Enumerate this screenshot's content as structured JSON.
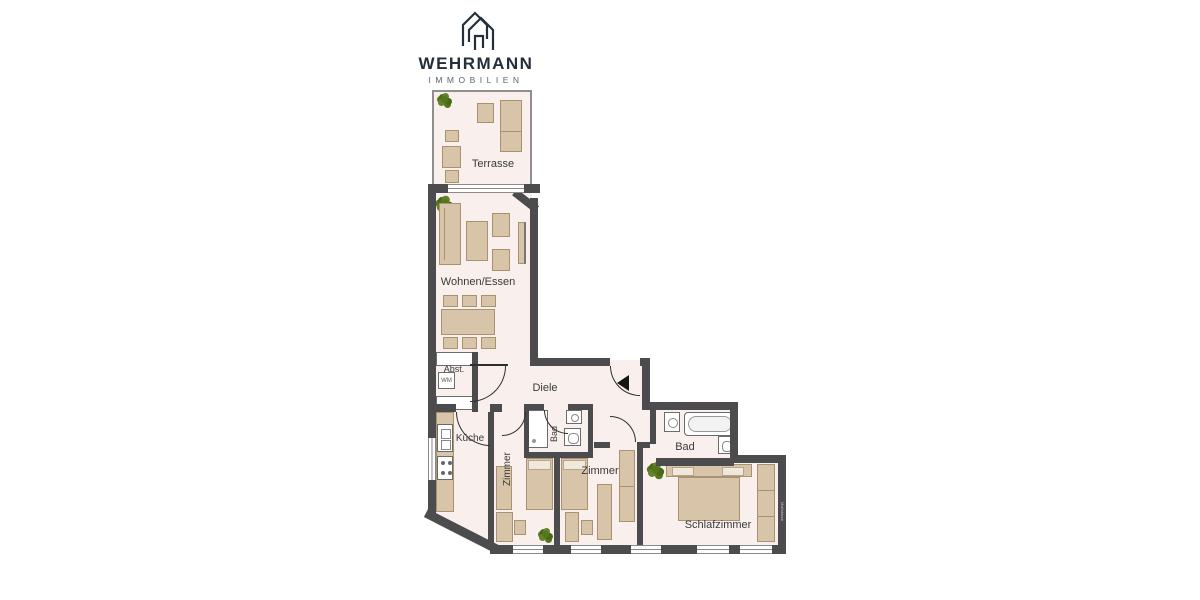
{
  "brand": {
    "name": "WEHRMANN",
    "subtitle": "IMMOBILIEN"
  },
  "floorplan": {
    "labels": {
      "terrasse": "Terrasse",
      "wohnen_essen": "Wohnen/Essen",
      "abstellraum": "Abst.",
      "washing_machine": "WM",
      "diele": "Diele",
      "kueche": "Küche",
      "zimmer_1": "Zimmer",
      "bad_klein": "Bad",
      "zimmer_2": "Zimmer",
      "bad_gross": "Bad",
      "schlafzimmer": "Schlafzimmer",
      "watermark": "Maßskizze"
    },
    "colors": {
      "wall": "#4c4b4d",
      "room_fill": "#f9efed",
      "furniture": "#d8c5a9",
      "furniture_border": "#a8926f",
      "plant": "#55761f",
      "logo": "#232f3a"
    }
  }
}
